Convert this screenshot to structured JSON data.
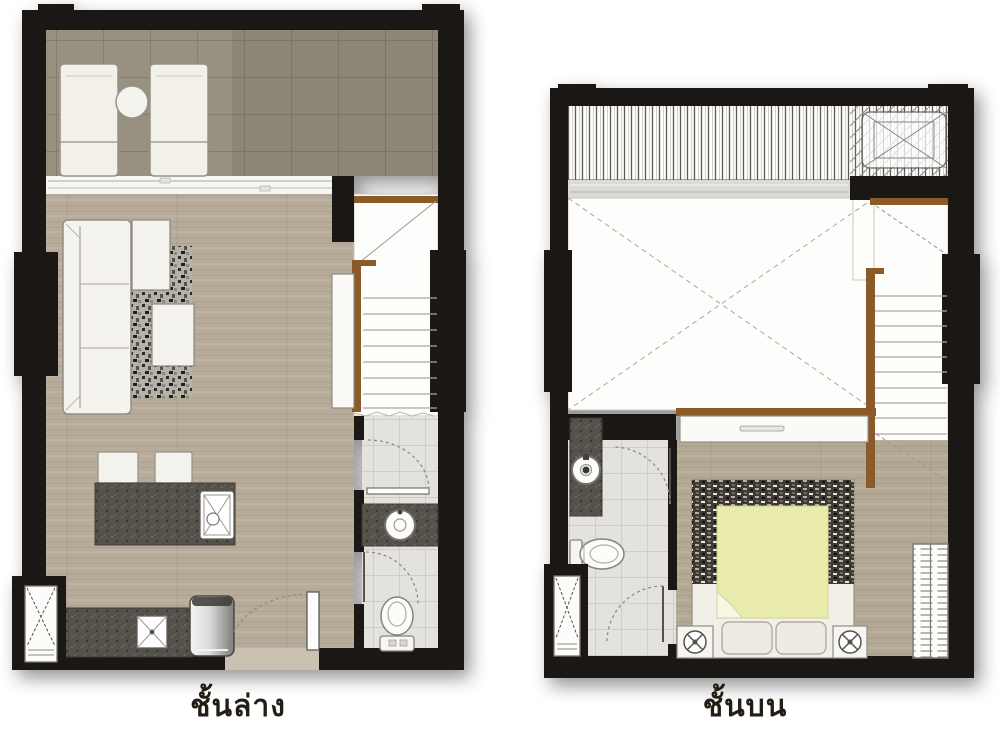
{
  "page": {
    "background_color": "#ffffff",
    "type": "two-storey-unit-floor-plan"
  },
  "floorplan": {
    "lower": {
      "label": "ชั้นล่าง",
      "rooms": [
        "balcony",
        "living-dining",
        "kitchenette",
        "bathroom",
        "staircase"
      ],
      "fixtures": [
        "lounge-chair",
        "lounge-chair",
        "round-side-table",
        "sofa",
        "rug",
        "side-table",
        "side-table",
        "bar-stool",
        "bar-stool",
        "kitchen-island-with-sink",
        "counter-with-sink",
        "refrigerator",
        "entrance-door",
        "washbasin",
        "toilet",
        "stair-up",
        "wardrobe-cabinet",
        "condenser-ledge"
      ]
    },
    "upper": {
      "label": "ชั้นบน",
      "rooms": [
        "louvered-ledge",
        "void-double-volume",
        "bedroom",
        "bathroom",
        "staircase"
      ],
      "fixtures": [
        "air-conditioner-unit",
        "dresser",
        "double-bed",
        "duvet",
        "pillow",
        "pillow",
        "nightstand-lamp",
        "nightstand-lamp",
        "wardrobe",
        "washbasin",
        "toilet",
        "stair-down",
        "condenser-ledge"
      ]
    }
  },
  "colors": {
    "wall": "#1b1714",
    "balcony_tile": "#98917f",
    "wood_floor": "#b7ac9a",
    "bathroom_tile": "#e3e2dd",
    "counter_speckle": "#55524c",
    "wood_trim": "#8a5a28",
    "bed_duvet": "#e9ebad",
    "furniture_white": "#f4f2ec",
    "label_text": "#221e14"
  }
}
